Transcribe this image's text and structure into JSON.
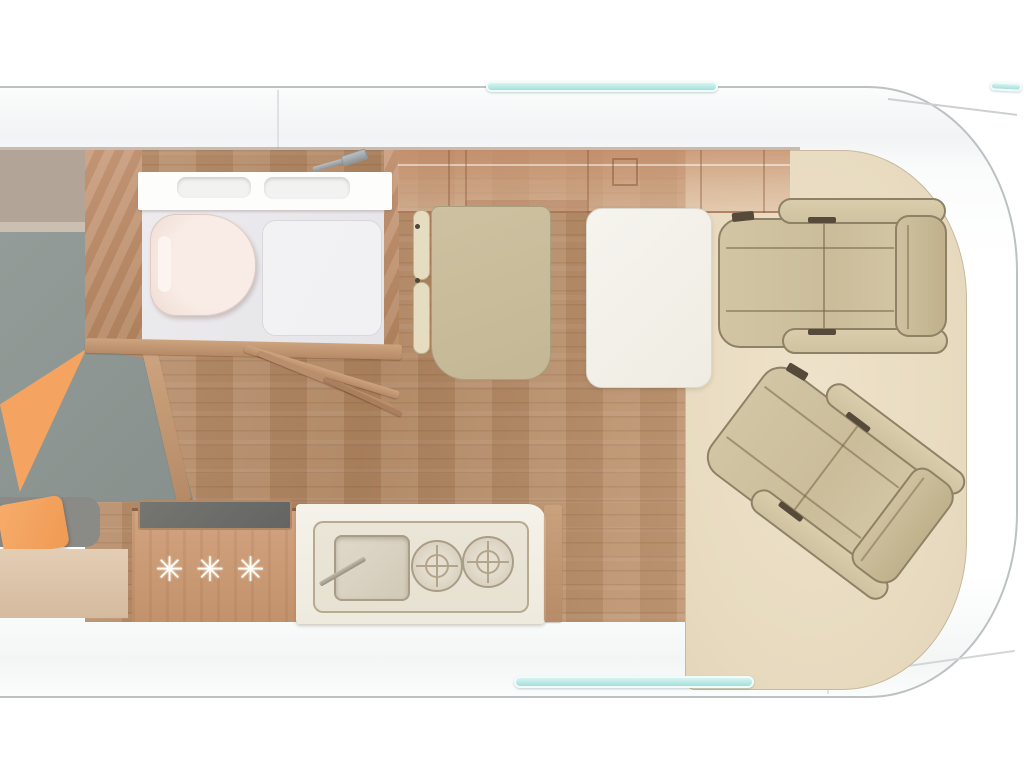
{
  "title": "Campervan top-view floor plan",
  "vehicle": {
    "view": "top-down cutaway",
    "body_color": "#fbfcfc",
    "outline_color": "#bcc1c3",
    "window_color": "#a3dfdb",
    "window_count": 3
  },
  "areas": {
    "bed": {
      "label": "rear bed",
      "blanket_color": "#8e9793",
      "accent_color": "#f4a361",
      "pillow": "orange cushion on gray bench"
    },
    "bathroom": {
      "label": "washroom",
      "fixtures": [
        "toilet",
        "double basin counter",
        "faucet",
        "shower tray",
        "folding door"
      ],
      "floor_color": "#e9e8ec"
    },
    "kitchen": {
      "label": "kitchenette",
      "fridge_symbols": "✳✳✳",
      "fixtures": [
        "compressor fridge",
        "sink with faucet",
        "two-burner hob"
      ],
      "counter_color": "#f3f0e8"
    },
    "dinette": {
      "label": "dinette",
      "bench_color": "#c9bd9e",
      "table_color": "#f4f2ec"
    },
    "cab": {
      "label": "driver cab",
      "mat_color": "#e9dcc3",
      "seat_color": "#d0c3a3",
      "swivel_seat_count": 2
    }
  },
  "floor": {
    "material": "wood planks",
    "color": "#b58b67"
  }
}
